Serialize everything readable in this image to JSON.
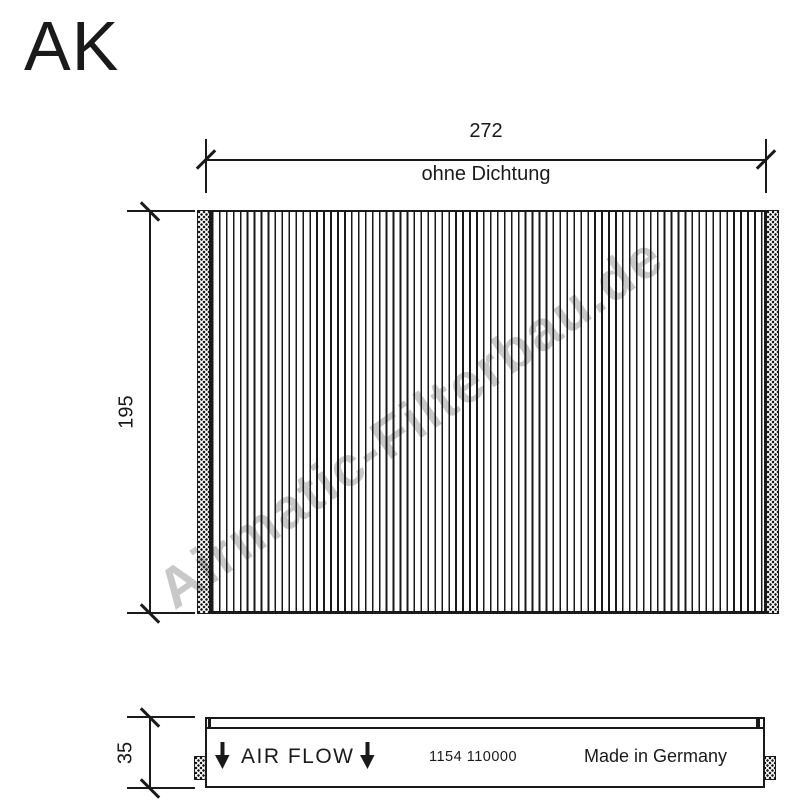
{
  "drawing": {
    "code": "AK",
    "watermark": "Airmatic-Filterbau.de"
  },
  "front_view": {
    "width_dim": {
      "value": "272",
      "note": "ohne Dichtung"
    },
    "height_dim": {
      "value": "195"
    }
  },
  "side_view": {
    "depth_dim": {
      "value": "35"
    },
    "air_flow_label": "AIR FLOW",
    "part_number": "1154 110000",
    "origin_label": "Made in Germany"
  },
  "icons": {
    "air_flow_arrow": "down-arrow"
  },
  "colors": {
    "ink": "#1a1a1a",
    "watermark": "#c8c8c8",
    "background": "#ffffff"
  }
}
